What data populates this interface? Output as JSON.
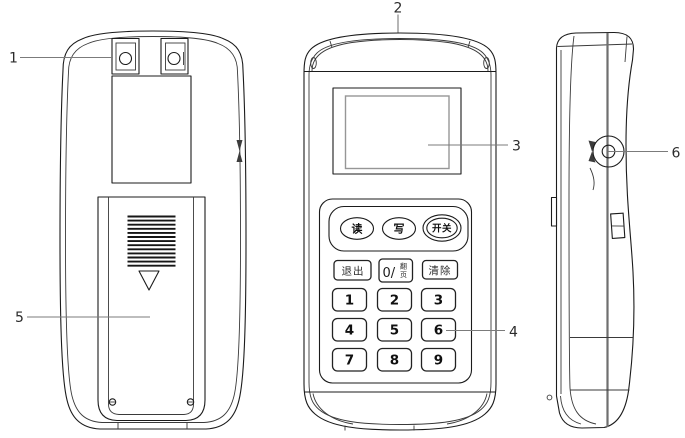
{
  "callouts": [
    {
      "label": "1"
    },
    {
      "label": "2"
    },
    {
      "label": "3"
    },
    {
      "label": "4"
    },
    {
      "label": "5"
    },
    {
      "label": "6"
    }
  ],
  "front_panel": {
    "function_buttons": [
      {
        "label": "读"
      },
      {
        "label": "写"
      },
      {
        "label": "开关"
      }
    ],
    "keypad": {
      "exit_label": "退出",
      "zero_label": "0/",
      "page_label_top": "翻",
      "page_label_bottom": "页",
      "clear_label": "清除",
      "digits": [
        "1",
        "2",
        "3",
        "4",
        "5",
        "6",
        "7",
        "8",
        "9"
      ]
    }
  },
  "colors": {
    "background": "#ffffff",
    "outline": "#1b1b1b",
    "callout_line": "#7b7b7b",
    "screen_inner_frame": "#969696"
  }
}
